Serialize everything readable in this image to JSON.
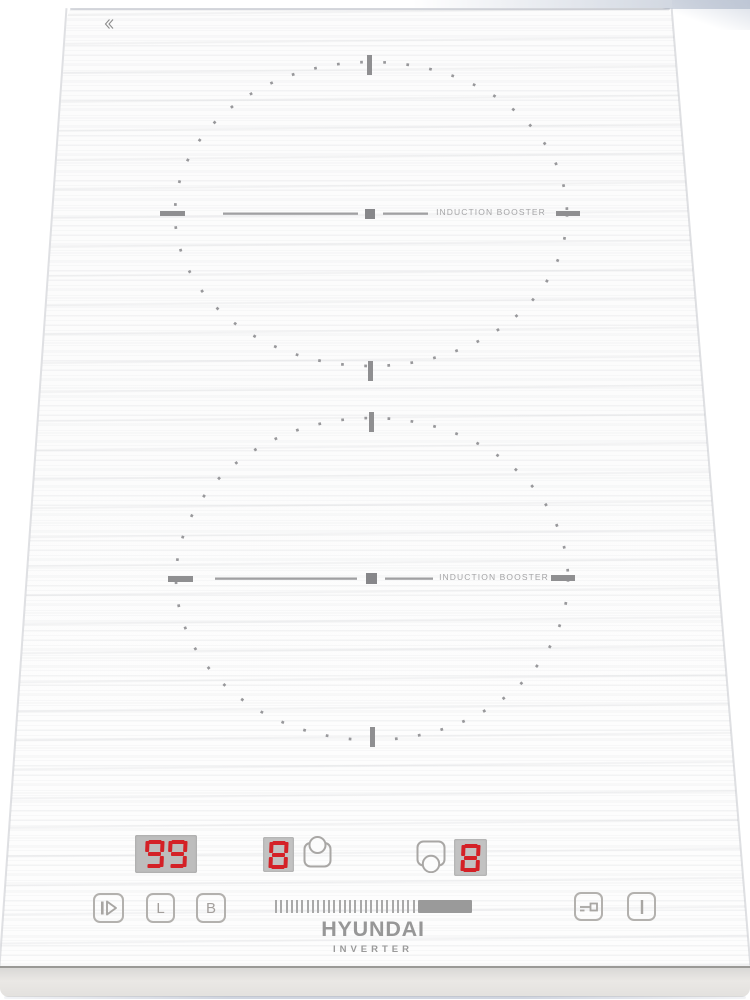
{
  "branding": {
    "logo": "HYUNDAI",
    "subtitle": "INVERTER"
  },
  "zones": [
    {
      "name": "rear",
      "booster_label": "INDUCTION BOOSTER"
    },
    {
      "name": "front",
      "booster_label": "INDUCTION BOOSTER"
    }
  ],
  "displays": {
    "timer": {
      "value": "99"
    },
    "rear_power": {
      "value": "8"
    },
    "front_power": {
      "value": "8"
    }
  },
  "controls": {
    "pause_button": {
      "icon": "play-pause-icon"
    },
    "lock_button": {
      "label": "L"
    },
    "booster_button": {
      "label": "B"
    },
    "power_slider": {
      "tick_count": 27,
      "fill_side": "right"
    },
    "key_lock_button": {
      "icon": "key-icon"
    },
    "power_button": {
      "icon": "power-bar-icon"
    },
    "rear_pot_icon": "pot-rear-icon",
    "front_pot_icon": "pot-front-icon"
  },
  "colors": {
    "led_red": "#d42127",
    "display_bg": "#bdbdbd",
    "control_gray": "#a8a6a3",
    "mark_gray": "#8f8f91",
    "metal_base": "#e4e2df"
  }
}
